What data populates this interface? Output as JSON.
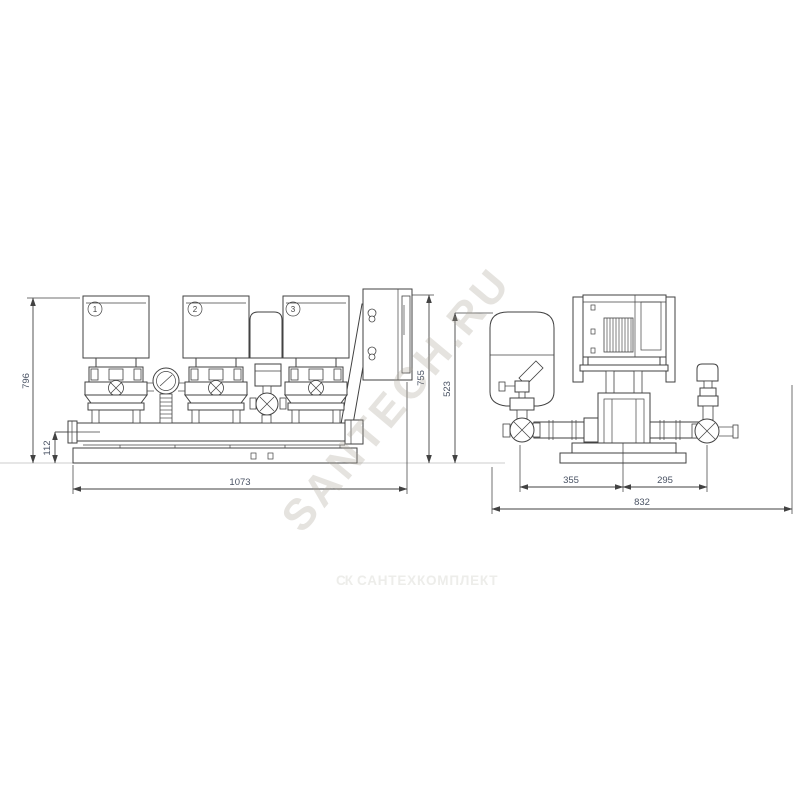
{
  "page": {
    "background": "#ffffff"
  },
  "watermark": {
    "diagonal_text": "SANTECH.RU",
    "bottom_logo": "СК",
    "bottom_text": "САНТЕХКОМПЛЕКТ"
  },
  "front_view": {
    "pumps": [
      {
        "label": "1"
      },
      {
        "label": "2"
      },
      {
        "label": "3"
      }
    ],
    "dims": {
      "overall_height": "796",
      "pipe_height": "112",
      "overall_width": "1073",
      "cabinet_height": "755"
    }
  },
  "side_view": {
    "dims": {
      "overall_height": "523",
      "span_left": "355",
      "span_right": "295",
      "overall_width": "832"
    }
  },
  "colors": {
    "line": "#424242",
    "dim_text": "#4a5364",
    "watermark_diagonal": "#a8a194",
    "watermark_bottom": "#ededea",
    "ground_line": "#cccccc"
  }
}
